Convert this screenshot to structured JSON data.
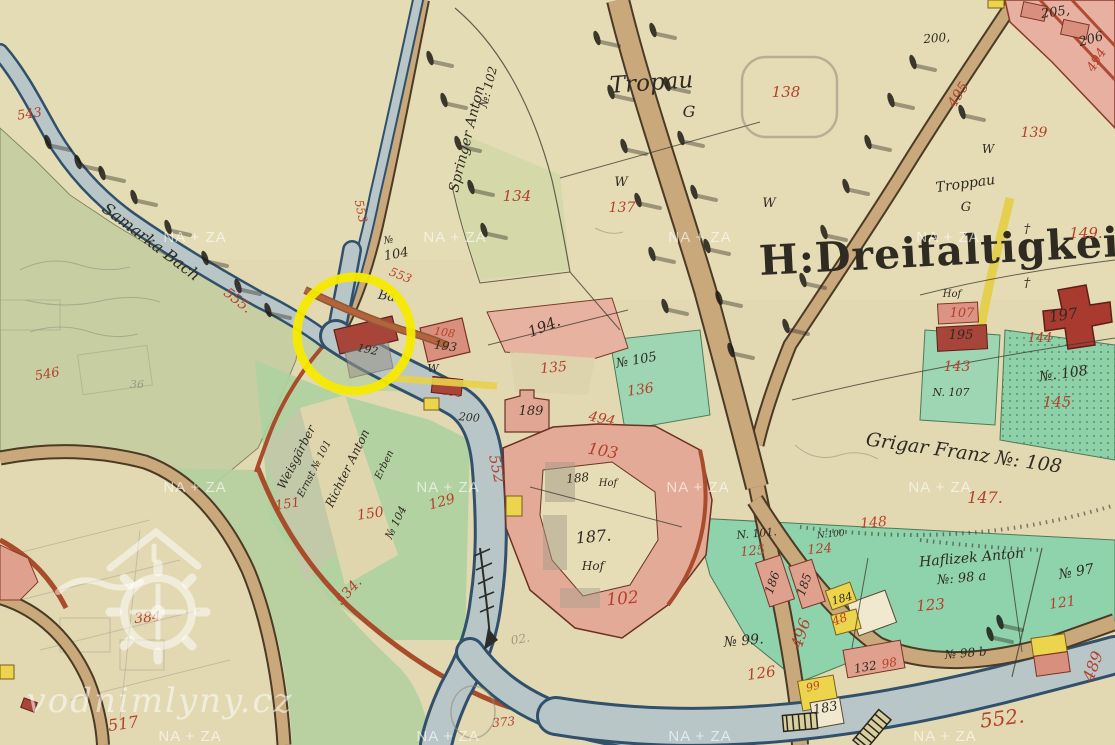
{
  "page": {
    "type": "historical-cadastral-map-scan",
    "source_watermark": "vodnimlyny.cz"
  },
  "map": {
    "colors": {
      "paper": "#e2d9b2",
      "field_green": "#c6cfa2",
      "meadow_green": "#8fd3ad",
      "bright_green": "#9ed6b4",
      "water_fill": "#b9c6c8",
      "water_edge": "#30506b",
      "road_tan": "#c9a97b",
      "bank_red_brown": "#a84c2c",
      "building_pink": "#e3ab97",
      "building_dark_red": "#a8453a",
      "building_yellow": "#ecd44c",
      "label_red": "#b5402c",
      "label_black": "#2f2a22",
      "pencil_gray": "#8f8a7a",
      "highlight_yellow": "#f5ea00",
      "watermark_white": "#ffffff"
    },
    "annotation": {
      "type": "circle",
      "cx": 354,
      "cy": 334,
      "r": 57,
      "stroke_width": 9,
      "purpose": "highlighted-mill-site"
    },
    "watermark": {
      "tile_text": "NA + ZA",
      "site_text": "vodnimlyny.cz",
      "logo": "water-mill-gear-and-house",
      "tile_positions": [
        [
          195,
          242
        ],
        [
          455,
          242
        ],
        [
          700,
          242
        ],
        [
          948,
          242
        ],
        [
          195,
          492
        ],
        [
          448,
          492
        ],
        [
          698,
          492
        ],
        [
          940,
          492
        ],
        [
          190,
          741
        ],
        [
          448,
          741
        ],
        [
          700,
          741
        ],
        [
          945,
          741
        ]
      ]
    },
    "place_labels": [
      {
        "t": "543",
        "x": 30,
        "y": 118,
        "r": -8,
        "c": "r",
        "s": 13
      },
      {
        "t": "555.",
        "x": 235,
        "y": 304,
        "r": 38,
        "c": "r",
        "s": 14
      },
      {
        "t": "Samarka Bach",
        "x": 148,
        "y": 246,
        "r": 37,
        "c": "k",
        "s": 16
      },
      {
        "t": "553",
        "x": 357,
        "y": 212,
        "r": 78,
        "c": "r",
        "s": 12
      },
      {
        "t": "553",
        "x": 399,
        "y": 279,
        "r": 22,
        "c": "r",
        "s": 12
      },
      {
        "t": "№",
        "x": 389,
        "y": 243,
        "r": -10,
        "c": "k",
        "s": 10
      },
      {
        "t": "104",
        "x": 397,
        "y": 258,
        "r": -10,
        "c": "k",
        "s": 13
      },
      {
        "t": "Springer Anton",
        "x": 471,
        "y": 140,
        "r": -76,
        "c": "k",
        "s": 14
      },
      {
        "t": "№: 102",
        "x": 492,
        "y": 88,
        "r": -76,
        "c": "k",
        "s": 12
      },
      {
        "t": "134",
        "x": 517,
        "y": 201,
        "r": 0,
        "c": "r",
        "s": 15
      },
      {
        "t": "Tropau",
        "x": 652,
        "y": 90,
        "r": -4,
        "c": "k",
        "s": 23
      },
      {
        "t": "G",
        "x": 689,
        "y": 117,
        "r": 0,
        "c": "k",
        "s": 16
      },
      {
        "t": "W",
        "x": 621,
        "y": 186,
        "r": 0,
        "c": "k",
        "s": 13
      },
      {
        "t": "137",
        "x": 622,
        "y": 212,
        "r": 0,
        "c": "r",
        "s": 14
      },
      {
        "t": "W",
        "x": 769,
        "y": 207,
        "r": 0,
        "c": "k",
        "s": 13
      },
      {
        "t": "138",
        "x": 786,
        "y": 97,
        "r": 0,
        "c": "r",
        "s": 15
      },
      {
        "t": "200,",
        "x": 937,
        "y": 42,
        "r": -5,
        "c": "k",
        "s": 12
      },
      {
        "t": "205,",
        "x": 1056,
        "y": 16,
        "r": -8,
        "c": "k",
        "s": 13
      },
      {
        "t": "206",
        "x": 1092,
        "y": 43,
        "r": -15,
        "c": "k",
        "s": 13
      },
      {
        "t": "495",
        "x": 962,
        "y": 97,
        "r": -58,
        "c": "r",
        "s": 14
      },
      {
        "t": "494",
        "x": 1100,
        "y": 62,
        "r": -58,
        "c": "r",
        "s": 13
      },
      {
        "t": "139",
        "x": 1034,
        "y": 137,
        "r": 0,
        "c": "r",
        "s": 14
      },
      {
        "t": "Troppau",
        "x": 966,
        "y": 188,
        "r": -8,
        "c": "k",
        "s": 14
      },
      {
        "t": "G",
        "x": 966,
        "y": 211,
        "r": 0,
        "c": "k",
        "s": 13
      },
      {
        "t": "W",
        "x": 988,
        "y": 153,
        "r": 0,
        "c": "k",
        "s": 12
      },
      {
        "t": "H:Dreifaltigkeit",
        "x": 950,
        "y": 265,
        "r": -3,
        "c": "k",
        "s": 41,
        "f": "b"
      },
      {
        "t": "149.",
        "x": 1086,
        "y": 238,
        "r": 0,
        "c": "r",
        "s": 15
      },
      {
        "t": "Hof",
        "x": 952,
        "y": 297,
        "r": 0,
        "c": "k",
        "s": 10
      },
      {
        "t": "107",
        "x": 962,
        "y": 317,
        "r": 0,
        "c": "r",
        "s": 13
      },
      {
        "t": "195",
        "x": 961,
        "y": 339,
        "r": 0,
        "c": "k",
        "s": 13
      },
      {
        "t": "197",
        "x": 1064,
        "y": 320,
        "r": -8,
        "c": "k",
        "s": 15
      },
      {
        "t": "144",
        "x": 1040,
        "y": 342,
        "r": 0,
        "c": "r",
        "s": 13
      },
      {
        "t": "143",
        "x": 957,
        "y": 371,
        "r": 0,
        "c": "r",
        "s": 14
      },
      {
        "t": "N. 107",
        "x": 951,
        "y": 396,
        "r": 0,
        "c": "k",
        "s": 11
      },
      {
        "t": "№. 108",
        "x": 1064,
        "y": 378,
        "r": -8,
        "c": "k",
        "s": 14
      },
      {
        "t": "145",
        "x": 1057,
        "y": 407,
        "r": 0,
        "c": "r",
        "s": 15
      },
      {
        "t": "Grigar Franz №: 108",
        "x": 963,
        "y": 459,
        "r": 8,
        "c": "k",
        "s": 19
      },
      {
        "t": "147.",
        "x": 985,
        "y": 503,
        "r": 0,
        "c": "r",
        "s": 16
      },
      {
        "t": "148",
        "x": 874,
        "y": 527,
        "r": -5,
        "c": "r",
        "s": 14
      },
      {
        "t": "194.",
        "x": 546,
        "y": 331,
        "r": -22,
        "c": "k",
        "s": 15
      },
      {
        "t": "135",
        "x": 554,
        "y": 372,
        "r": -5,
        "c": "r",
        "s": 14
      },
      {
        "t": "№ 105",
        "x": 637,
        "y": 364,
        "r": -10,
        "c": "k",
        "s": 13
      },
      {
        "t": "136",
        "x": 641,
        "y": 394,
        "r": -8,
        "c": "r",
        "s": 14
      },
      {
        "t": "189",
        "x": 531,
        "y": 415,
        "r": 0,
        "c": "k",
        "s": 13
      },
      {
        "t": "494",
        "x": 601,
        "y": 423,
        "r": 12,
        "c": "r",
        "s": 14
      },
      {
        "t": "103",
        "x": 602,
        "y": 456,
        "r": 10,
        "c": "r",
        "s": 16
      },
      {
        "t": "188",
        "x": 578,
        "y": 482,
        "r": -5,
        "c": "k",
        "s": 12
      },
      {
        "t": "Hof",
        "x": 608,
        "y": 486,
        "r": 0,
        "c": "k",
        "s": 10
      },
      {
        "t": "187.",
        "x": 594,
        "y": 542,
        "r": -5,
        "c": "k",
        "s": 16
      },
      {
        "t": "Hof",
        "x": 593,
        "y": 570,
        "r": 0,
        "c": "k",
        "s": 12
      },
      {
        "t": "102",
        "x": 623,
        "y": 604,
        "r": -5,
        "c": "r",
        "s": 17
      },
      {
        "t": "552",
        "x": 492,
        "y": 470,
        "r": 78,
        "c": "r",
        "s": 15
      },
      {
        "t": "129",
        "x": 443,
        "y": 506,
        "r": -15,
        "c": "r",
        "s": 14
      },
      {
        "t": "191",
        "x": 452,
        "y": 396,
        "r": 8,
        "c": "r",
        "s": 11
      },
      {
        "t": "200",
        "x": 469,
        "y": 421,
        "r": 5,
        "c": "k",
        "s": 11
      },
      {
        "t": "Ba",
        "x": 386,
        "y": 300,
        "r": 10,
        "c": "k",
        "s": 13
      },
      {
        "t": "105",
        "x": 356,
        "y": 337,
        "r": 12,
        "c": "r",
        "s": 11
      },
      {
        "t": "192",
        "x": 367,
        "y": 353,
        "r": 12,
        "c": "k",
        "s": 11
      },
      {
        "t": "108",
        "x": 444,
        "y": 336,
        "r": 8,
        "c": "r",
        "s": 11
      },
      {
        "t": "193",
        "x": 445,
        "y": 350,
        "r": 8,
        "c": "k",
        "s": 12
      },
      {
        "t": "W",
        "x": 433,
        "y": 372,
        "r": 0,
        "c": "k",
        "s": 11
      },
      {
        "t": "Weisgärber",
        "x": 300,
        "y": 459,
        "r": -63,
        "c": "k",
        "s": 12
      },
      {
        "t": "Ernst № 101",
        "x": 317,
        "y": 470,
        "r": -63,
        "c": "k",
        "s": 10
      },
      {
        "t": "Richter Anton",
        "x": 351,
        "y": 470,
        "r": -64,
        "c": "k",
        "s": 12
      },
      {
        "t": "Erben",
        "x": 387,
        "y": 466,
        "r": -64,
        "c": "k",
        "s": 10
      },
      {
        "t": "№ 104",
        "x": 399,
        "y": 524,
        "r": -64,
        "c": "k",
        "s": 11
      },
      {
        "t": "150",
        "x": 371,
        "y": 518,
        "r": -8,
        "c": "r",
        "s": 14
      },
      {
        "t": "151",
        "x": 288,
        "y": 508,
        "r": -8,
        "c": "r",
        "s": 13
      },
      {
        "t": "534.",
        "x": 352,
        "y": 594,
        "r": -48,
        "c": "r",
        "s": 14
      },
      {
        "t": "546",
        "x": 48,
        "y": 378,
        "r": -10,
        "c": "r",
        "s": 13
      },
      {
        "t": "36",
        "x": 137,
        "y": 388,
        "r": 0,
        "c": "p",
        "s": 11
      },
      {
        "t": "384",
        "x": 148,
        "y": 622,
        "r": -5,
        "c": "r",
        "s": 14
      },
      {
        "t": "517",
        "x": 124,
        "y": 729,
        "r": -8,
        "c": "r",
        "s": 16
      },
      {
        "t": "02.",
        "x": 521,
        "y": 643,
        "r": -10,
        "c": "p",
        "s": 12
      },
      {
        "t": "373",
        "x": 504,
        "y": 726,
        "r": -5,
        "c": "r",
        "s": 12
      },
      {
        "t": "552.",
        "x": 1003,
        "y": 725,
        "r": -7,
        "c": "r",
        "s": 20
      },
      {
        "t": "489",
        "x": 1098,
        "y": 668,
        "r": -70,
        "c": "r",
        "s": 16
      },
      {
        "t": "496",
        "x": 806,
        "y": 635,
        "r": -72,
        "c": "r",
        "s": 16
      },
      {
        "t": "N. 101.",
        "x": 757,
        "y": 537,
        "r": -5,
        "c": "k",
        "s": 11
      },
      {
        "t": "N:100",
        "x": 831,
        "y": 537,
        "r": -5,
        "c": "k",
        "s": 9
      },
      {
        "t": "125",
        "x": 753,
        "y": 555,
        "r": -5,
        "c": "r",
        "s": 13
      },
      {
        "t": "124",
        "x": 820,
        "y": 553,
        "r": -5,
        "c": "r",
        "s": 13
      },
      {
        "t": "186",
        "x": 776,
        "y": 584,
        "r": -70,
        "c": "k",
        "s": 12
      },
      {
        "t": "185",
        "x": 808,
        "y": 586,
        "r": -70,
        "c": "k",
        "s": 12
      },
      {
        "t": "184",
        "x": 843,
        "y": 602,
        "r": -15,
        "c": "k",
        "s": 11
      },
      {
        "t": "48",
        "x": 841,
        "y": 623,
        "r": -20,
        "c": "r",
        "s": 12
      },
      {
        "t": "132",
        "x": 866,
        "y": 671,
        "r": -10,
        "c": "k",
        "s": 12
      },
      {
        "t": "98",
        "x": 890,
        "y": 667,
        "r": -10,
        "c": "r",
        "s": 12
      },
      {
        "t": "№ 98 b",
        "x": 966,
        "y": 657,
        "r": -5,
        "c": "k",
        "s": 12
      },
      {
        "t": "Haflizek Anton",
        "x": 972,
        "y": 562,
        "r": -5,
        "c": "k",
        "s": 14
      },
      {
        "t": "№: 98 a",
        "x": 962,
        "y": 582,
        "r": -5,
        "c": "k",
        "s": 13
      },
      {
        "t": "№ 97",
        "x": 1077,
        "y": 576,
        "r": -10,
        "c": "k",
        "s": 14
      },
      {
        "t": "123",
        "x": 931,
        "y": 610,
        "r": -5,
        "c": "r",
        "s": 15
      },
      {
        "t": "121",
        "x": 1063,
        "y": 607,
        "r": -8,
        "c": "r",
        "s": 14
      },
      {
        "t": "№ 99.",
        "x": 744,
        "y": 645,
        "r": -5,
        "c": "k",
        "s": 14
      },
      {
        "t": "126",
        "x": 762,
        "y": 678,
        "r": -8,
        "c": "r",
        "s": 15
      },
      {
        "t": "99",
        "x": 814,
        "y": 690,
        "r": -15,
        "c": "r",
        "s": 11
      },
      {
        "t": "183",
        "x": 826,
        "y": 712,
        "r": -10,
        "c": "k",
        "s": 13
      },
      {
        "t": "†",
        "x": 1027,
        "y": 233,
        "r": 0,
        "c": "k",
        "s": 13
      },
      {
        "t": "†",
        "x": 1027,
        "y": 287,
        "r": 0,
        "c": "k",
        "s": 13
      }
    ],
    "trees": [
      [
        48,
        142
      ],
      [
        78,
        162
      ],
      [
        102,
        173
      ],
      [
        134,
        197
      ],
      [
        168,
        227
      ],
      [
        205,
        258
      ],
      [
        238,
        286
      ],
      [
        268,
        310
      ],
      [
        430,
        58
      ],
      [
        444,
        100
      ],
      [
        458,
        143
      ],
      [
        471,
        187
      ],
      [
        484,
        230
      ],
      [
        597,
        38
      ],
      [
        611,
        92
      ],
      [
        624,
        146
      ],
      [
        638,
        200
      ],
      [
        652,
        254
      ],
      [
        665,
        306
      ],
      [
        653,
        30
      ],
      [
        667,
        84
      ],
      [
        681,
        138
      ],
      [
        694,
        192
      ],
      [
        707,
        246
      ],
      [
        719,
        298
      ],
      [
        731,
        350
      ],
      [
        913,
        62
      ],
      [
        891,
        100
      ],
      [
        868,
        142
      ],
      [
        846,
        186
      ],
      [
        824,
        232
      ],
      [
        803,
        280
      ],
      [
        786,
        326
      ],
      [
        962,
        112
      ],
      [
        990,
        634
      ],
      [
        1000,
        622
      ]
    ]
  }
}
